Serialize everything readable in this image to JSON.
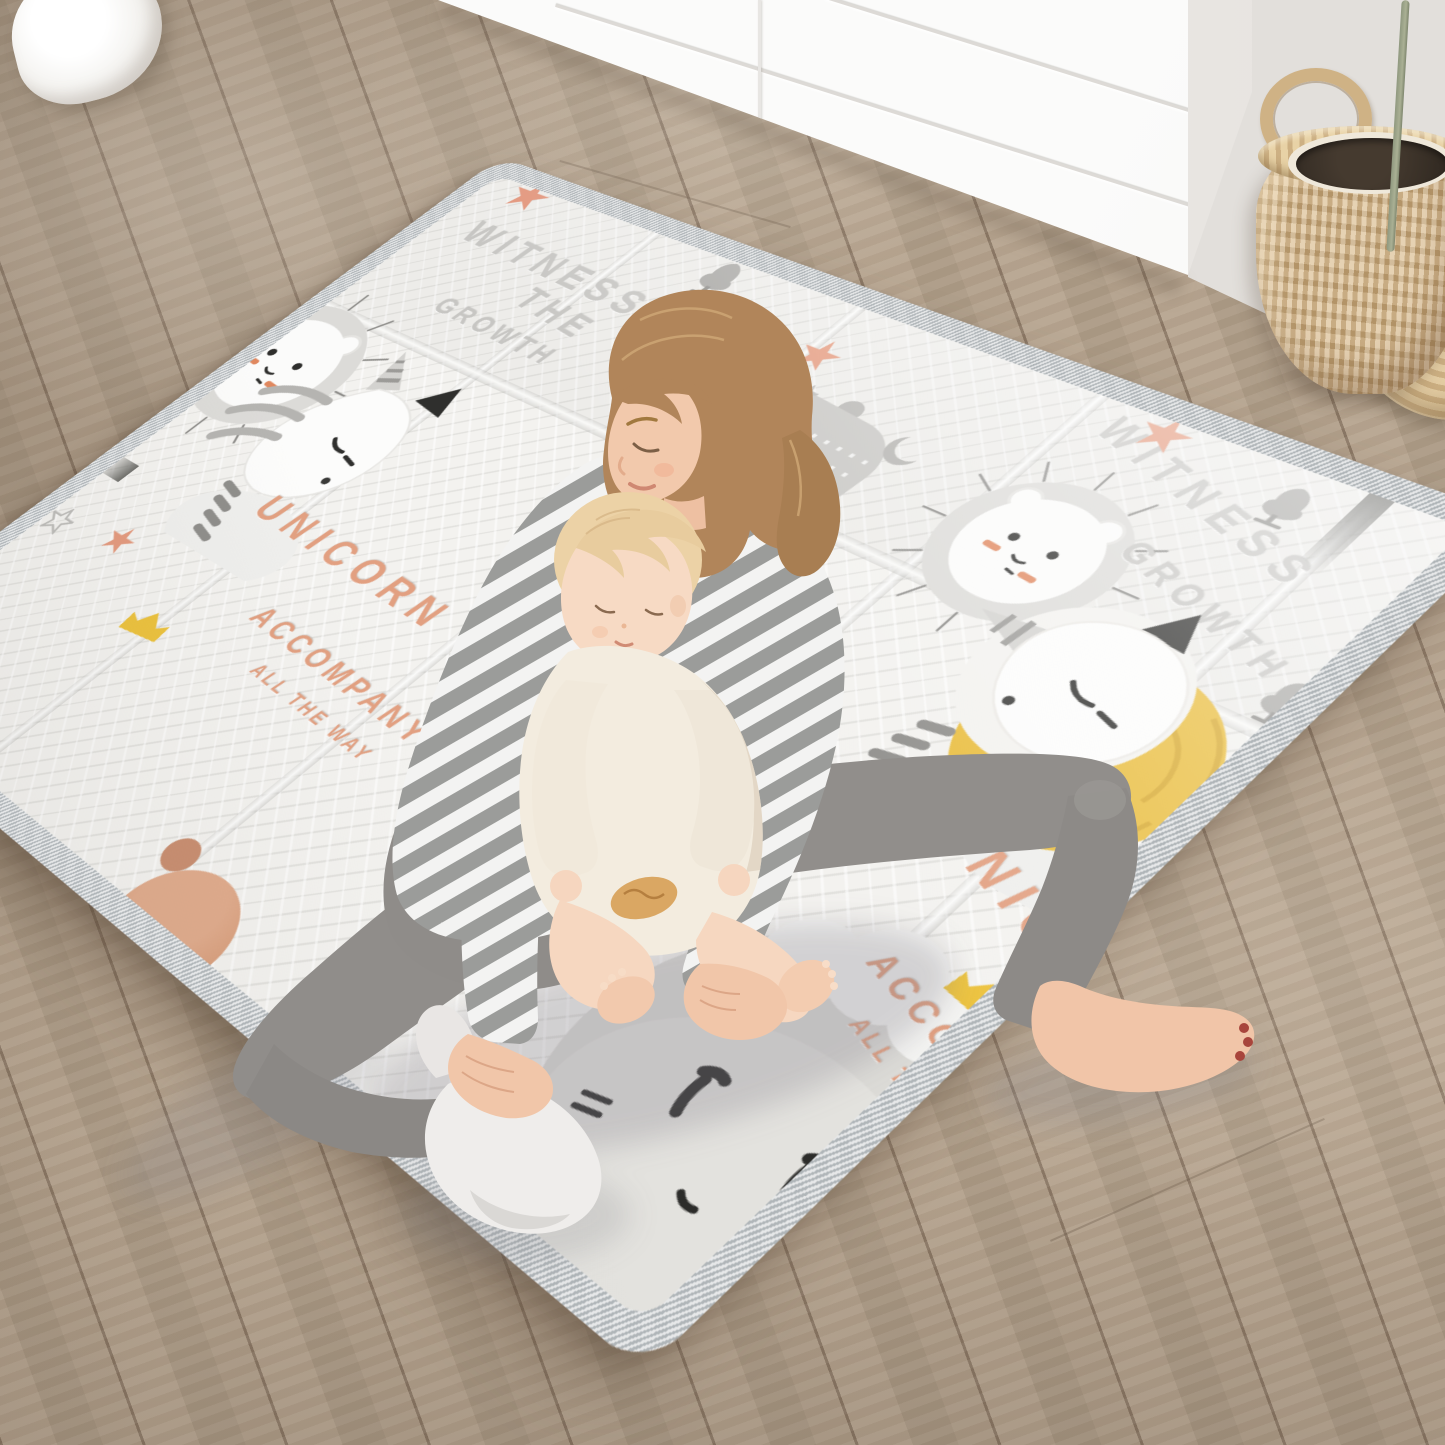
{
  "scene": {
    "description": "Mother and baby sitting on a foldable cartoon play mat in a bright nursery with white dresser, wicker plant basket and wooden floor",
    "floor_color": "#b2a08c",
    "furniture_color": "#fbfbfa",
    "wall_color": "#e9e7e3"
  },
  "mat": {
    "texts": {
      "witness": "WITNESS",
      "the": "THE",
      "growth": "GROWTH",
      "unicorn": "UNICORN",
      "accompany": "ACCOMPANY",
      "all_the_way": "ALL THE WAY"
    },
    "colors": {
      "surface": "#f3f2f0",
      "trim": "#c9cdcf",
      "text_gray": "#c7c6c3",
      "text_salmon": "#e2a081",
      "star_orange": "#e49a7e",
      "accent_yellow": "#ecc23d",
      "art_gray": "#c9c8c5"
    }
  }
}
